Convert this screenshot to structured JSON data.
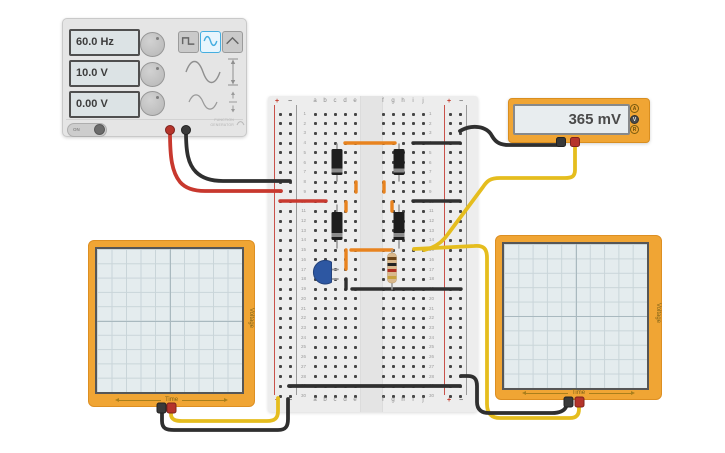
{
  "colors": {
    "wire_red": "#c8382e",
    "wire_black": "#2f2f2f",
    "wire_orange": "#e8831f",
    "wire_yellow": "#e5bd1e",
    "body_orange": "#f0a534",
    "accent_blue": "#45aee0",
    "led_blue": "#2d57a2"
  },
  "function_generator": {
    "frequency": "60.0 Hz",
    "amplitude": "10.0 V",
    "dc_offset": "0.00 V",
    "power_label": "ON",
    "device_label_line1": "FUNCTION",
    "device_label_line2": "GENERATOR",
    "wave_buttons": [
      "square",
      "sine",
      "triangle"
    ],
    "selected_wave": "sine"
  },
  "multimeter": {
    "reading": "365 mV",
    "mode_buttons": [
      "A",
      "V",
      "R"
    ],
    "selected_mode": "V"
  },
  "oscilloscope_left": {
    "x_label": "Time",
    "y_label": "Voltage"
  },
  "oscilloscope_right": {
    "x_label": "Time",
    "y_label": "Voltage"
  },
  "breadboard": {
    "row_count": 30,
    "left_columns": [
      "a",
      "b",
      "c",
      "d",
      "e"
    ],
    "right_columns": [
      "f",
      "g",
      "h",
      "i",
      "j"
    ],
    "rail_positive": "+",
    "rail_negative": "−"
  }
}
